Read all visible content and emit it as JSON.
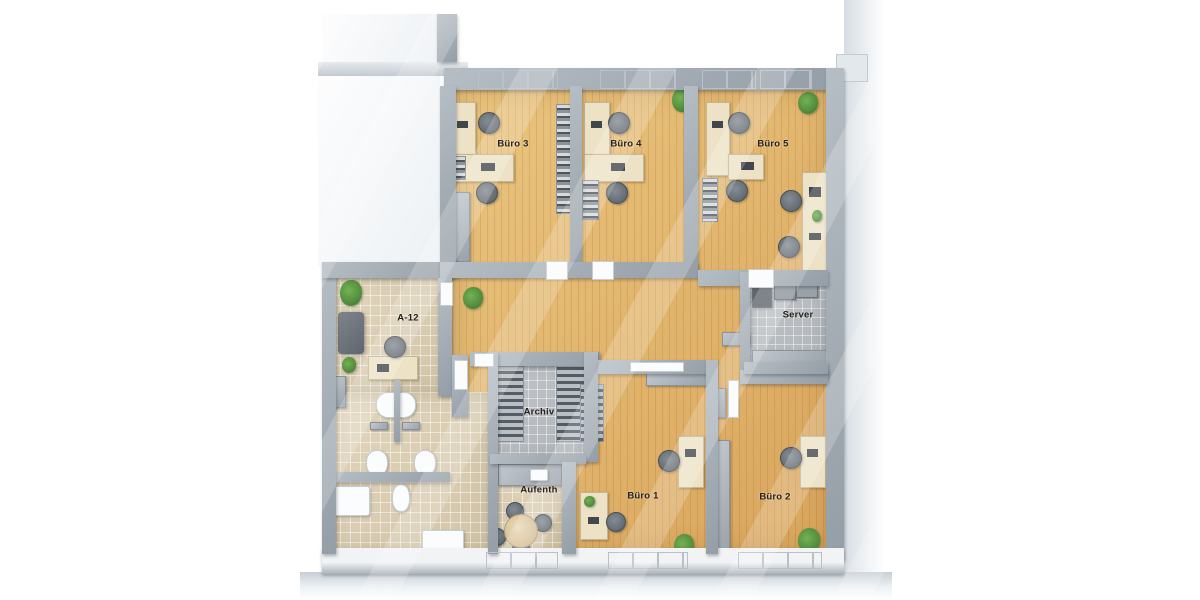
{
  "scene": {
    "type": "3d-office-floor-plan-render",
    "description": "Top-down 3D rendering of an office floor with five offices, reception, archive, break room, server room and WC area"
  },
  "rooms": [
    {
      "id": "buero-3",
      "label": "Büro 3",
      "floor": "wood"
    },
    {
      "id": "buero-4",
      "label": "Büro 4",
      "floor": "wood"
    },
    {
      "id": "buero-5",
      "label": "Büro 5",
      "floor": "wood"
    },
    {
      "id": "a-12",
      "label": "A-12",
      "floor": "beige-tile"
    },
    {
      "id": "server",
      "label": "Server",
      "floor": "gray-tile"
    },
    {
      "id": "archiv",
      "label": "Archiv",
      "floor": "gray-tile"
    },
    {
      "id": "aufenth",
      "label": "Aufenth",
      "floor": "beige-tile"
    },
    {
      "id": "buero-1",
      "label": "Büro 1",
      "floor": "wood"
    },
    {
      "id": "buero-2",
      "label": "Büro 2",
      "floor": "wood"
    }
  ],
  "colors": {
    "wood_floor": "#e0b06a",
    "tile_beige": "#d9cdb2",
    "tile_gray": "#b9bec2",
    "wall": "#9ba4ac",
    "wall_top_face": "#f1f3f5",
    "exterior_ground": "#dde3e8",
    "desk": "#eee2c6",
    "chair": "#6d747b",
    "plant": "#4e8f3d",
    "fixture_white": "#fbfcfd",
    "label_text": "#26211c"
  }
}
